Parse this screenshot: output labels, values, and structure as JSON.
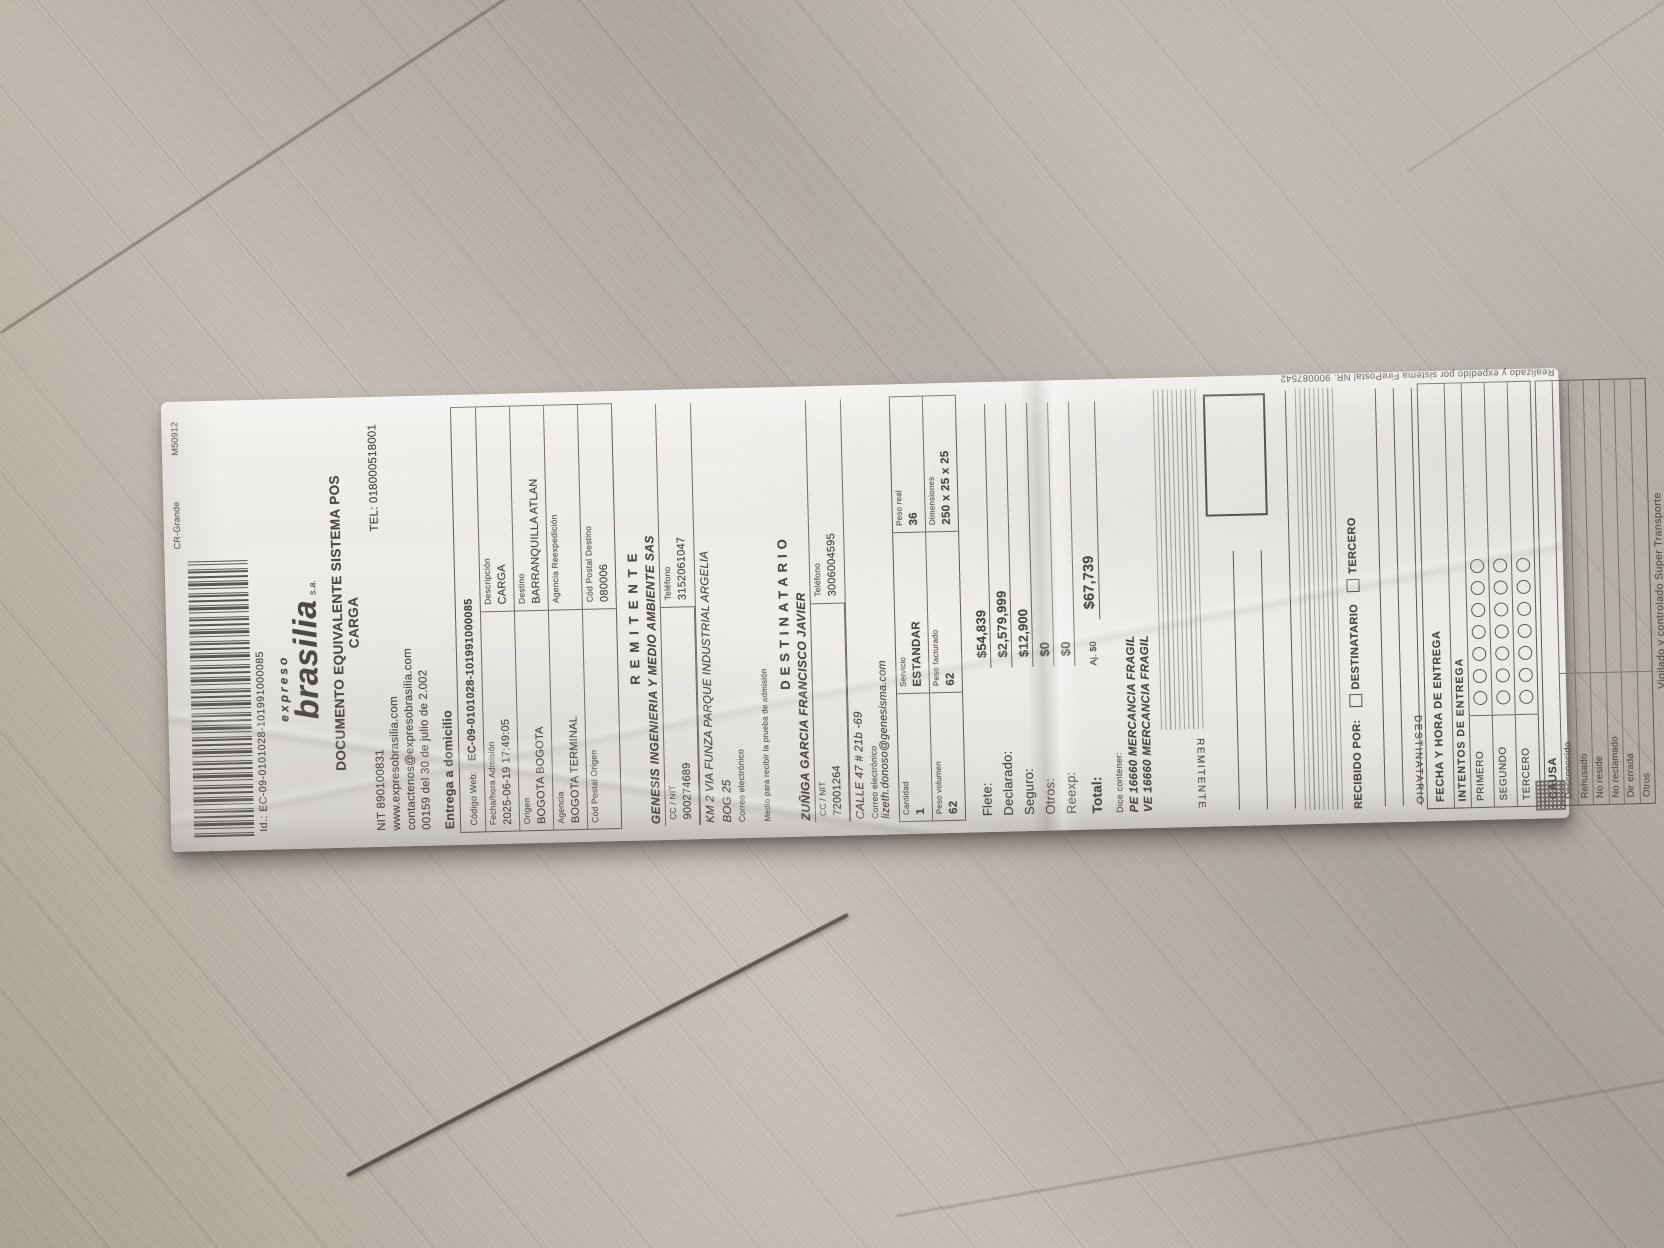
{
  "receipt": {
    "top_line": {
      "left": "CR-Grande",
      "right": "M50912"
    },
    "id_line": "Id.: EC-09-0101028-101991000085",
    "brand": {
      "pre": "expreso",
      "name": "brasilia",
      "suffix": "s.a."
    },
    "title_line1": "DOCUMENTO EQUIVALENTE SISTEMA POS",
    "title_line2": "CARGA",
    "nit": "NIT 890100831",
    "tel": "TEL: 018000518001",
    "website": "www.expresobrasilia.com",
    "contact_email": "contactenos@expresobrasilia.com",
    "resolution": "00159 del 30 de julio de 2.002",
    "delivery_mode": "Entrega a domicilio",
    "codigo_web": {
      "label": "Código Web:",
      "value": "EC-09-0101028-101991000085"
    },
    "info_grid": [
      {
        "l_label": "Fecha/hora Admisión",
        "l_value": "2025-06-19 17:49:05",
        "r_label": "Descripción",
        "r_value": "CARGA"
      },
      {
        "l_label": "Origen",
        "l_value": "BOGOTA BOGOTA",
        "r_label": "Destino",
        "r_value": "BARRANQUILLA ATLAN"
      },
      {
        "l_label": "Agencia",
        "l_value": "BOGOTA TERMINAL",
        "r_label": "Agencia Reexpedición",
        "r_value": ""
      },
      {
        "l_label": "Cód Postal Origen",
        "l_value": "",
        "r_label": "Cód Postal Destino",
        "r_value": "080006"
      }
    ],
    "remitente": {
      "header": "REMITENTE",
      "name": "GENESIS INGENIERIA Y MEDIO AMBIENTE SAS",
      "id_label": "CC / NIT",
      "id_value": "900274689",
      "phone_label": "Teléfono",
      "phone_value": "3152061047",
      "address1": "KM 2 VIA FUNZA PARQUE INDUSTRIAL ARGELIA",
      "address2": "BOG 25",
      "email_label": "Correo electrónico",
      "email_value": "",
      "note": "Medio para recibir la prueba de admisión"
    },
    "destinatario": {
      "header": "DESTINATARIO",
      "name": "ZUÑIGA GARCIA FRANCISCO JAVIER",
      "id_label": "CC / NIT",
      "id_value": "72001264",
      "phone_label": "Teléfono",
      "phone_value": "3006004595",
      "address1": "CALLE 47 # 21b -69",
      "email_label": "Correo electrónico",
      "email_value": "lizeth.donoso@genesisma.com"
    },
    "package": {
      "r1": [
        {
          "label": "Cantidad",
          "value": "1"
        },
        {
          "label": "Servicio",
          "value": "ESTANDAR"
        },
        {
          "label": "Peso real",
          "value": "36"
        }
      ],
      "r2": [
        {
          "label": "Peso volumen",
          "value": "62"
        },
        {
          "label": "Peso facturado",
          "value": "62"
        },
        {
          "label": "Dimensiones",
          "value": "250 x 25 x 25"
        }
      ]
    },
    "charges": [
      {
        "label": "Flete:",
        "value": "$54,839"
      },
      {
        "label": "Declarado:",
        "value": "$2,579,999"
      },
      {
        "label": "Seguro:",
        "value": "$12,900"
      },
      {
        "label": "Otros:",
        "value": "$0"
      },
      {
        "label": "Reexp:",
        "value": "$0"
      }
    ],
    "total": {
      "label": "Total:",
      "adjust": "Aj.  $0",
      "value": "$67,739"
    },
    "contents": {
      "label": "Dice contener:",
      "lines": [
        "PE 16660 MERCANCIA FRAGIL",
        "VE 16660 MERCANCIA FRAGIL"
      ]
    },
    "signatures": {
      "remitente_label": "REMITENTE",
      "recibido_por": "RECIBIDO POR:",
      "recibido_opts": [
        "DESTINATARIO",
        "TERCERO"
      ],
      "destinatario_label": "DESTINATARIO",
      "fecha_entrega": "FECHA Y HORA DE ENTREGA"
    },
    "intentos": {
      "header": "INTENTOS DE ENTREGA",
      "rows": [
        "PRIMERO",
        "SEGUNDO",
        "TERCERO"
      ],
      "circles_per_row": 7
    },
    "causa": {
      "label": "CAUSA",
      "items": [
        "Desconocido",
        "Rehusado",
        "No reside",
        "No reclamado",
        "Dir errada",
        "Otros"
      ]
    },
    "footer": {
      "vigilado": "Vigilado y controlado Super Transporte",
      "sistema": "Realizado y expedido por sistema FirePostal NR. 900087542"
    }
  }
}
